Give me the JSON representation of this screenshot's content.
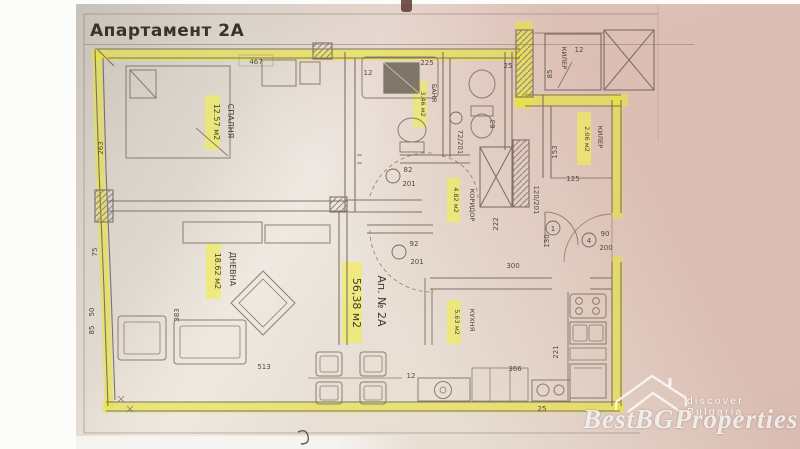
{
  "title": "Апартамент 2А",
  "apartment": {
    "name": "Ап. № 2А",
    "area": "56,38 м2"
  },
  "rooms": {
    "bedroom": {
      "name": "СПАЛНЯ",
      "area": "12.57 м2"
    },
    "living": {
      "name": "ДНЕВНА",
      "area": "18.62 м2"
    },
    "bath": {
      "name": "БАНЯ",
      "area": "3.46 м2"
    },
    "corridor": {
      "name": "КОРИДОР",
      "area": "4.82 м2"
    },
    "kitchen": {
      "name": "КУХНЯ",
      "area": "5.63 м2"
    },
    "pantry": {
      "name": "КИЛЕР",
      "area": "2.06 м2"
    },
    "pantry_small": {
      "name": "КИЛЕР"
    }
  },
  "doors": {
    "bedroom": {
      "w": "82",
      "h": "201"
    },
    "living": {
      "w": "92",
      "h": "201"
    },
    "bath": {
      "label": "72/201"
    },
    "pantry": {
      "label": "120/201"
    },
    "entry": {
      "w": "90",
      "h": "200",
      "num": "4"
    },
    "hall_num": "1"
  },
  "dims": {
    "top_width": "467",
    "bedroom_height": "263",
    "bath_width": "225",
    "bath_note": "12",
    "wc_width": "63",
    "wc_wall": "25",
    "shaft_w": "12",
    "shaft_h": "85",
    "pantry_height": "153",
    "pantry_width": "125",
    "hall_height": "222",
    "hall_width": "130",
    "kitchen_width": "300",
    "kitchen_bottom": "366",
    "kitchen_height": "221",
    "living_width": "383",
    "living_bottom": "513",
    "left_a": "75",
    "left_b": "50",
    "left_c": "85",
    "bottom_a": "12",
    "bottom_b": "25"
  },
  "watermark": {
    "brand": "BestBGProperties",
    "tagline": "discover Bulgaria"
  },
  "colors": {
    "highlight": "#e6e33c",
    "label_highlight": "#f0ec5a",
    "ink": "#6f6054",
    "text": "#453b31",
    "paper": "#eae2d8"
  }
}
